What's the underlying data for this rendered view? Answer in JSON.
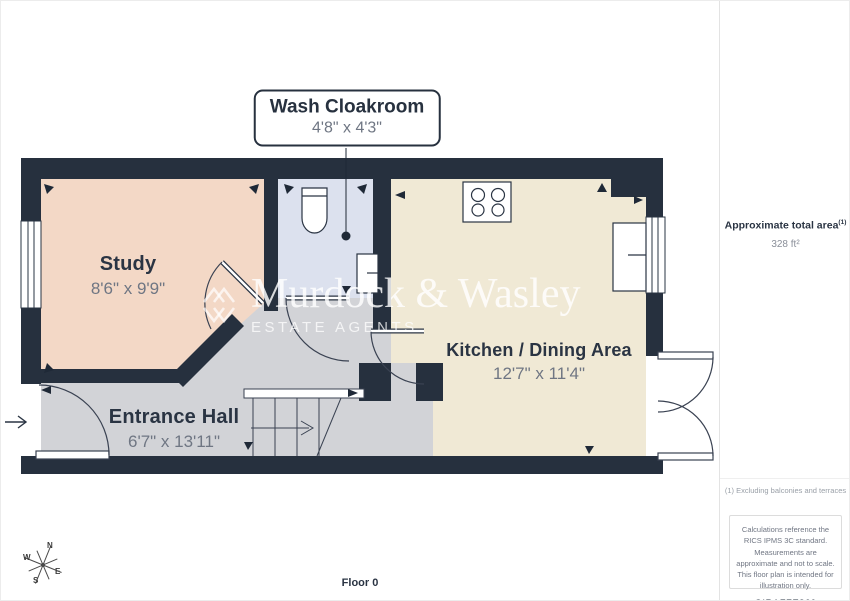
{
  "floorplan": {
    "floor_label": "Floor 0",
    "compass": {
      "n": "N",
      "e": "E",
      "s": "S",
      "w": "W"
    },
    "watermark": {
      "name": "Murdock & Wasley",
      "tagline": "ESTATE AGENTS"
    },
    "wall_color": "#26303e",
    "rooms": {
      "study": {
        "name": "Study",
        "dimensions": "8'6\" x 9'9\"",
        "color": "#f3d8c6"
      },
      "entrance_hall": {
        "name": "Entrance Hall",
        "dimensions": "6'7\" x 13'11\"",
        "color": "#d2d3d7"
      },
      "kitchen_dining": {
        "name": "Kitchen / Dining Area",
        "dimensions": "12'7\" x 11'4\"",
        "color": "#f0e9d5"
      },
      "wash_cloakroom": {
        "name": "Wash Cloakroom",
        "dimensions": "4'8\" x 4'3\"",
        "color": "#dce1ee"
      }
    }
  },
  "sidebar": {
    "area_title": "Approximate total area",
    "area_footnote_marker": "(1)",
    "area_value": "328 ft²",
    "footnote": "(1) Excluding balconies and terraces",
    "disclaimer": "Calculations reference the RICS IPMS 3C standard. Measurements are approximate and not to scale. This floor plan is intended for illustration only.",
    "brand_name": "GIRAFFE",
    "brand_suffix": "360"
  }
}
